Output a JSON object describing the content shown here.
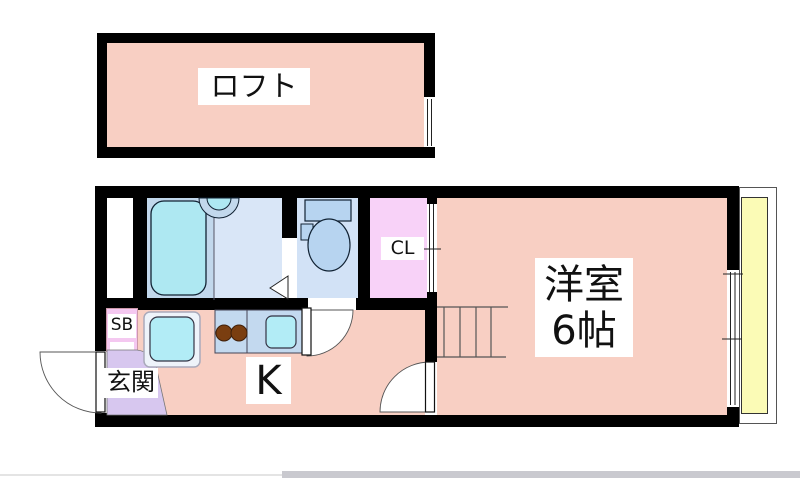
{
  "plan_type": "apartment-floor-plan",
  "rooms": {
    "loft": {
      "label": "ロフト",
      "color": "#f8cfc3"
    },
    "western_room": {
      "label": "洋室",
      "size_label": "6帖",
      "color": "#f8cfc3"
    },
    "kitchen": {
      "label": "K",
      "color": "#f8cfc3"
    },
    "closet": {
      "label": "CL",
      "color": "#f8d2f8"
    },
    "entrance": {
      "label": "玄関",
      "color": "#d7c7ef"
    },
    "shoe_box": {
      "label": "SB",
      "color": "#f4c8f0"
    },
    "bathroom": {
      "color": "#c2d8ec"
    },
    "washroom": {
      "color": "#d9e6f7"
    },
    "toilet_room": {
      "color": "#d2e2f6"
    },
    "balcony": {
      "color": "#fbfbb6"
    }
  },
  "fixtures": [
    "bathtub",
    "wash-basin",
    "toilet",
    "kitchen-sink",
    "gas-stove-2-burners",
    "washing-machine-pan",
    "staircase",
    "closet-sliding-door",
    "entrance-door",
    "bathroom-folding-door",
    "interior-door",
    "windows"
  ],
  "colors": {
    "wall": "#000000",
    "fixture_cyan": "#b2ecf6",
    "fixture_blue": "#b7d4f0",
    "counter_blue": "#c3d9ef",
    "stove_brown": "#7a3e10",
    "balcony_yellow": "#fbfbb6"
  }
}
